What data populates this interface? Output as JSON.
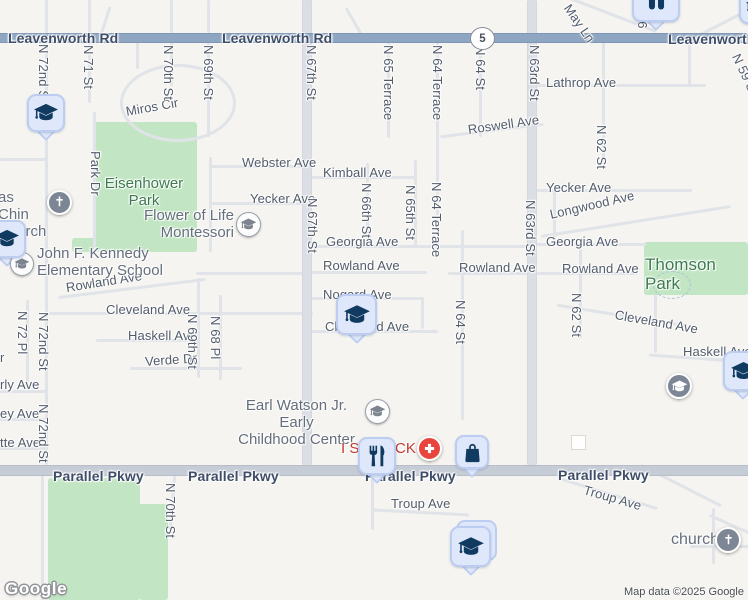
{
  "map": {
    "logo": "Google",
    "attribution": "Map data ©2025 Google",
    "route_shield": {
      "number": "5",
      "x": 470,
      "y": 27
    },
    "colors": {
      "background": "#f5f4f0",
      "highway_road": "#8ea6c2",
      "parkway_road": "#c6ccd5",
      "minor_road": "#e0e3e8",
      "park_green": "#c2e6c3",
      "park_label_green": "#3c7b50",
      "street_label": "#525c6b",
      "poi_label_gray": "#656e7c",
      "poi_label_red": "#c03a30",
      "marker_fill": "#dfe8fa",
      "marker_border": "#bccdf1",
      "marker_glyph": "#113a60",
      "poi_circle_gray": "#7d8694",
      "poi_circle_red": "#e8453c"
    },
    "parks": [
      {
        "x": 93,
        "y": 122,
        "w": 104,
        "h": 130
      },
      {
        "x": 72,
        "y": 238,
        "w": 125,
        "h": 14
      },
      {
        "x": 644,
        "y": 242,
        "w": 104,
        "h": 53
      },
      {
        "x": 48,
        "y": 478,
        "w": 92,
        "h": 122
      },
      {
        "x": 139,
        "y": 504,
        "w": 29,
        "h": 96
      }
    ],
    "park_trails": [
      {
        "x": 653,
        "y": 271,
        "w": 36,
        "h": 26
      }
    ],
    "buildings": [
      {
        "x": 571,
        "y": 435,
        "w": 13,
        "h": 13
      }
    ],
    "roads": [
      {
        "cls": "st",
        "x": 45,
        "y": 0,
        "w": 3,
        "h": 33
      },
      {
        "cls": "st",
        "x": 45,
        "y": 41,
        "w": 3,
        "h": 424
      },
      {
        "cls": "st",
        "x": 41,
        "y": 474,
        "w": 3,
        "h": 126
      },
      {
        "cls": "st",
        "x": 88,
        "y": 0,
        "w": 3,
        "h": 33
      },
      {
        "cls": "st",
        "x": 88,
        "y": 41,
        "w": 3,
        "h": 62
      },
      {
        "cls": "st",
        "x": 170,
        "y": 0,
        "w": 3,
        "h": 33
      },
      {
        "cls": "st",
        "x": 170,
        "y": 41,
        "w": 3,
        "h": 45
      },
      {
        "cls": "st",
        "x": 207,
        "y": 0,
        "w": 3,
        "h": 33
      },
      {
        "cls": "st",
        "x": 207,
        "y": 41,
        "w": 3,
        "h": 96
      },
      {
        "cls": "st",
        "x": 93,
        "y": 112,
        "w": 3,
        "h": 140
      },
      {
        "cls": "st",
        "x": 136,
        "y": 41,
        "w": 3,
        "h": 28
      },
      {
        "cls": "st",
        "x": 387,
        "y": 41,
        "w": 3,
        "h": 97
      },
      {
        "cls": "st",
        "x": 436,
        "y": 41,
        "w": 3,
        "h": 206
      },
      {
        "cls": "st",
        "x": 479,
        "y": 41,
        "w": 3,
        "h": 96
      },
      {
        "cls": "st",
        "x": 602,
        "y": 41,
        "w": 3,
        "h": 120
      },
      {
        "cls": "st",
        "x": 688,
        "y": 41,
        "w": 3,
        "h": 46
      },
      {
        "cls": "st",
        "x": 553,
        "y": 190,
        "w": 3,
        "h": 55
      },
      {
        "cls": "st",
        "x": 366,
        "y": 163,
        "w": 3,
        "h": 84
      },
      {
        "cls": "st",
        "x": 414,
        "y": 160,
        "w": 3,
        "h": 87
      },
      {
        "cls": "st",
        "x": 461,
        "y": 230,
        "w": 3,
        "h": 190
      },
      {
        "cls": "st",
        "x": 579,
        "y": 248,
        "w": 3,
        "h": 90
      },
      {
        "cls": "st",
        "x": 654,
        "y": 295,
        "w": 3,
        "h": 58
      },
      {
        "cls": "st",
        "x": 209,
        "y": 157,
        "w": 3,
        "h": 95
      },
      {
        "cls": "st",
        "x": 197,
        "y": 278,
        "w": 3,
        "h": 100
      },
      {
        "cls": "st",
        "x": 219,
        "y": 295,
        "w": 3,
        "h": 85
      },
      {
        "cls": "st",
        "x": 26,
        "y": 300,
        "w": 3,
        "h": 82
      },
      {
        "cls": "st",
        "x": 171,
        "y": 474,
        "w": 3,
        "h": 56,
        "rot": 5
      },
      {
        "cls": "st",
        "x": 371,
        "y": 474,
        "w": 3,
        "h": 56
      },
      {
        "cls": "st",
        "x": 421,
        "y": 297,
        "w": 3,
        "h": 32
      },
      {
        "cls": "st",
        "x": 712,
        "y": 508,
        "w": 3,
        "h": 56
      },
      {
        "cls": "st",
        "x": 104,
        "y": 6,
        "w": 3,
        "h": 30,
        "rot": 18
      },
      {
        "cls": "st",
        "x": 352,
        "y": 6,
        "w": 3,
        "h": 30,
        "rot": -30
      },
      {
        "cls": "st",
        "x": 536,
        "y": 84,
        "w": 170,
        "h": 3
      },
      {
        "cls": "st",
        "x": 440,
        "y": 129,
        "w": 104,
        "h": 3,
        "rot": -7
      },
      {
        "cls": "st",
        "x": 209,
        "y": 165,
        "w": 96,
        "h": 3
      },
      {
        "cls": "st",
        "x": 311,
        "y": 176,
        "w": 106,
        "h": 3
      },
      {
        "cls": "st",
        "x": 212,
        "y": 202,
        "w": 93,
        "h": 3
      },
      {
        "cls": "st",
        "x": 536,
        "y": 189,
        "w": 156,
        "h": 3
      },
      {
        "cls": "st",
        "x": 311,
        "y": 245,
        "w": 219,
        "h": 3
      },
      {
        "cls": "st",
        "x": 536,
        "y": 243,
        "w": 110,
        "h": 3
      },
      {
        "cls": "st",
        "x": 540,
        "y": 220,
        "w": 192,
        "h": 3,
        "rot": -9
      },
      {
        "cls": "st",
        "x": 58,
        "y": 287,
        "w": 148,
        "h": 3,
        "rot": -7
      },
      {
        "cls": "st",
        "x": 196,
        "y": 272,
        "w": 117,
        "h": 3
      },
      {
        "cls": "st",
        "x": 311,
        "y": 271,
        "w": 116,
        "h": 3
      },
      {
        "cls": "st",
        "x": 448,
        "y": 272,
        "w": 82,
        "h": 3
      },
      {
        "cls": "st",
        "x": 536,
        "y": 272,
        "w": 102,
        "h": 3
      },
      {
        "cls": "st",
        "x": 311,
        "y": 297,
        "w": 113,
        "h": 3
      },
      {
        "cls": "st",
        "x": 46,
        "y": 312,
        "w": 267,
        "h": 3
      },
      {
        "cls": "st",
        "x": 311,
        "y": 330,
        "w": 127,
        "h": 3
      },
      {
        "cls": "st",
        "x": 556,
        "y": 314,
        "w": 132,
        "h": 3,
        "rot": 9
      },
      {
        "cls": "st",
        "x": 96,
        "y": 339,
        "w": 104,
        "h": 3
      },
      {
        "cls": "st",
        "x": 649,
        "y": 357,
        "w": 100,
        "h": 3,
        "rot": 4
      },
      {
        "cls": "st",
        "x": 130,
        "y": 367,
        "w": 112,
        "h": 3
      },
      {
        "cls": "st",
        "x": 373,
        "y": 511,
        "w": 96,
        "h": 3,
        "rot": 3
      },
      {
        "cls": "st",
        "x": 556,
        "y": 492,
        "w": 104,
        "h": 3,
        "rot": 17
      },
      {
        "cls": "st",
        "x": 0,
        "y": 390,
        "w": 47,
        "h": 3
      },
      {
        "cls": "st",
        "x": 0,
        "y": 418,
        "w": 47,
        "h": 3
      },
      {
        "cls": "st",
        "x": 0,
        "y": 447,
        "w": 47,
        "h": 3
      },
      {
        "cls": "st",
        "x": 0,
        "y": 158,
        "w": 47,
        "h": 3
      },
      {
        "cls": "st",
        "x": 0,
        "y": 230,
        "w": 47,
        "h": 3
      },
      {
        "cls": "st",
        "x": 548,
        "y": 10,
        "w": 112,
        "h": 3,
        "rot": 21
      },
      {
        "cls": "st",
        "x": 690,
        "y": 18,
        "w": 80,
        "h": 3,
        "rot": -27
      },
      {
        "cls": "st",
        "x": 636,
        "y": 484,
        "w": 90,
        "h": 3,
        "rot": 27
      },
      {
        "cls": "st",
        "x": 706,
        "y": 530,
        "w": 80,
        "h": 3,
        "rot": 24
      },
      {
        "cls": "st",
        "x": 690,
        "y": 545,
        "w": 60,
        "h": 3
      },
      {
        "cls": "ellipse",
        "x": 120,
        "y": 64,
        "w": 110,
        "h": 72
      },
      {
        "cls": "col",
        "x": 303,
        "y": 0,
        "w": 8,
        "h": 465
      },
      {
        "cls": "col",
        "x": 528,
        "y": 0,
        "w": 8,
        "h": 465
      },
      {
        "cls": "hwy",
        "x": 0,
        "y": 33,
        "w": 748,
        "h": 8
      },
      {
        "cls": "pkwy",
        "x": 0,
        "y": 465,
        "w": 748,
        "h": 9
      }
    ],
    "street_labels": [
      {
        "t": "Leavenworth Rd",
        "x": 8,
        "y": 30,
        "major": true
      },
      {
        "t": "Leavenworth Rd",
        "x": 222,
        "y": 30,
        "major": true
      },
      {
        "t": "Leavenworth Rd",
        "x": 668,
        "y": 31,
        "major": true
      },
      {
        "t": "Parallel Pkwy",
        "x": 53,
        "y": 468,
        "major": true
      },
      {
        "t": "Parallel Pkwy",
        "x": 188,
        "y": 468,
        "major": true
      },
      {
        "t": "Parallel Pkwy",
        "x": 365,
        "y": 468,
        "major": true
      },
      {
        "t": "Parallel Pkwy",
        "x": 558,
        "y": 467,
        "major": true
      },
      {
        "t": "Lathrop Ave",
        "x": 546,
        "y": 75
      },
      {
        "t": "Roswell Ave",
        "x": 468,
        "y": 122,
        "rot": -8
      },
      {
        "t": "Webster Ave",
        "x": 242,
        "y": 155
      },
      {
        "t": "Kimball Ave",
        "x": 323,
        "y": 165
      },
      {
        "t": "Yecker Ave",
        "x": 250,
        "y": 191
      },
      {
        "t": "Yecker Ave",
        "x": 546,
        "y": 180
      },
      {
        "t": "Georgia Ave",
        "x": 326,
        "y": 234
      },
      {
        "t": "Georgia Ave",
        "x": 546,
        "y": 234
      },
      {
        "t": "Longwood Ave",
        "x": 550,
        "y": 207,
        "rot": -13
      },
      {
        "t": "Rowland Ave",
        "x": 66,
        "y": 280,
        "rot": -9
      },
      {
        "t": "Rowland Ave",
        "x": 323,
        "y": 258
      },
      {
        "t": "Rowland Ave",
        "x": 459,
        "y": 260
      },
      {
        "t": "Rowland Ave",
        "x": 562,
        "y": 261
      },
      {
        "t": "Nogard Ave",
        "x": 323,
        "y": 287
      },
      {
        "t": "Cleveland Ave",
        "x": 106,
        "y": 302
      },
      {
        "t": "Cleveland Ave",
        "x": 325,
        "y": 319
      },
      {
        "t": "Cleveland Ave",
        "x": 615,
        "y": 307,
        "rot": 10
      },
      {
        "t": "Haskell Ave",
        "x": 128,
        "y": 328
      },
      {
        "t": "Haskell Ave",
        "x": 683,
        "y": 344
      },
      {
        "t": "Verde Dr",
        "x": 145,
        "y": 354,
        "rot": -4
      },
      {
        "t": "Troup Ave",
        "x": 391,
        "y": 496
      },
      {
        "t": "Troup Ave",
        "x": 584,
        "y": 482,
        "rot": 16
      },
      {
        "t": "Miros Cir",
        "x": 126,
        "y": 104,
        "rot": -10
      },
      {
        "t": "May Ln",
        "x": 567,
        "y": -2,
        "rot": 55
      },
      {
        "t": "N 59 St",
        "x": 736,
        "y": 47,
        "rot": 65
      },
      {
        "t": "rly Ave",
        "x": 0,
        "y": 377
      },
      {
        "t": "r",
        "x": 0,
        "y": 350
      },
      {
        "t": "ey Ave",
        "x": 0,
        "y": 406
      },
      {
        "t": "tte Ave",
        "x": 0,
        "y": 435
      },
      {
        "t": "N 72nd St",
        "x": 36,
        "y": 44,
        "v": true
      },
      {
        "t": "N 71 St",
        "x": 81,
        "y": 45,
        "v": true
      },
      {
        "t": "N 70th St",
        "x": 161,
        "y": 45,
        "v": true
      },
      {
        "t": "N 69th St",
        "x": 201,
        "y": 45,
        "v": true
      },
      {
        "t": "N 67th St",
        "x": 304,
        "y": 45,
        "v": true
      },
      {
        "t": "N 65 Terrace",
        "x": 381,
        "y": 45,
        "v": true
      },
      {
        "t": "N 64 Terrace",
        "x": 430,
        "y": 45,
        "v": true
      },
      {
        "t": "N 64 St",
        "x": 473,
        "y": 46,
        "v": true
      },
      {
        "t": "N 63rd St",
        "x": 527,
        "y": 45,
        "v": true
      },
      {
        "t": "N 6",
        "x": 635,
        "y": 8,
        "v": true
      },
      {
        "t": "N 62 St",
        "x": 594,
        "y": 125,
        "v": true
      },
      {
        "t": "Park Dr",
        "x": 88,
        "y": 151,
        "v": true
      },
      {
        "t": "N 67th St",
        "x": 305,
        "y": 198,
        "v": true
      },
      {
        "t": "N 66th St",
        "x": 359,
        "y": 183,
        "v": true
      },
      {
        "t": "N 65th St",
        "x": 403,
        "y": 185,
        "v": true
      },
      {
        "t": "N 64 Terrace",
        "x": 429,
        "y": 182,
        "v": true
      },
      {
        "t": "N 63rd St",
        "x": 523,
        "y": 200,
        "v": true
      },
      {
        "t": "N 62 St",
        "x": 569,
        "y": 293,
        "v": true
      },
      {
        "t": "N 64 St",
        "x": 453,
        "y": 300,
        "v": true
      },
      {
        "t": "N 69th St",
        "x": 185,
        "y": 314,
        "v": true
      },
      {
        "t": "N 68 Pl",
        "x": 208,
        "y": 316,
        "v": true
      },
      {
        "t": "N 72 Pl",
        "x": 15,
        "y": 311,
        "v": true
      },
      {
        "t": "N 72nd St",
        "x": 36,
        "y": 312,
        "v": true
      },
      {
        "t": "N 72nd St",
        "x": 36,
        "y": 404,
        "v": true
      },
      {
        "t": "N 70th St",
        "x": 163,
        "y": 483,
        "v": true
      }
    ],
    "poi_labels": [
      {
        "lines": [
          "Eisenhower",
          "Park"
        ],
        "x": 98,
        "y": 176,
        "w": 92,
        "align": "center",
        "cls": "park-label",
        "size": 15
      },
      {
        "lines": [
          "Thomson Park"
        ],
        "x": 645,
        "y": 255,
        "w": 110,
        "align": "left",
        "cls": "park-label",
        "size": 17
      },
      {
        "lines": [
          "Flower of Life",
          "Montessori"
        ],
        "x": 138,
        "y": 208,
        "w": 96,
        "align": "right",
        "cls": "poi-gray",
        "size": 15
      },
      {
        "lines": [
          "John F. Kennedy",
          "Elementary School"
        ],
        "x": 37,
        "y": 246,
        "w": 130,
        "align": "left",
        "cls": "poi-gray",
        "size": 15
      },
      {
        "lines": [
          "Earl Watson Jr. Early",
          "Childhood Center"
        ],
        "x": 228,
        "y": 398,
        "w": 137,
        "align": "center",
        "cls": "poi-gray",
        "size": 15
      },
      {
        "lines": [
          "as Chin",
          "Church"
        ],
        "x": -2,
        "y": 190,
        "w": 48,
        "align": "left",
        "cls": "poi-gray",
        "size": 15
      },
      {
        "lines": [
          "church"
        ],
        "x": 671,
        "y": 531,
        "w": 48,
        "align": "left",
        "cls": "poi-gray",
        "size": 16
      },
      {
        "lines": [
          "I S"
        ],
        "x": 341,
        "y": 441,
        "w": 24,
        "align": "left",
        "cls": "poi-red",
        "size": 15
      },
      {
        "lines": [
          "CK"
        ],
        "x": 395,
        "y": 441,
        "w": 24,
        "align": "left",
        "cls": "poi-red",
        "size": 15
      }
    ],
    "markers": [
      {
        "id": "school-pin-1",
        "type": "square",
        "icon": "graduation-cap",
        "x": 27,
        "y": 94,
        "size": 38
      },
      {
        "id": "school-circle-1",
        "type": "circle",
        "variant": "white",
        "icon": "graduation-cap",
        "x": 10,
        "y": 252,
        "size": 24
      },
      {
        "id": "school-pin-2",
        "type": "square",
        "icon": "graduation-cap",
        "x": -12,
        "y": 220,
        "size": 38
      },
      {
        "id": "church-circle-1",
        "type": "circle",
        "variant": "gray",
        "icon": "church-cross",
        "x": 47,
        "y": 190,
        "size": 25
      },
      {
        "id": "school-circle-2",
        "type": "circle",
        "variant": "white",
        "icon": "graduation-cap",
        "x": 236,
        "y": 212,
        "size": 25
      },
      {
        "id": "school-pin-3",
        "type": "square",
        "icon": "graduation-cap",
        "x": 336,
        "y": 294,
        "size": 41
      },
      {
        "id": "school-circle-3",
        "type": "circle",
        "variant": "white",
        "icon": "graduation-cap",
        "x": 365,
        "y": 399,
        "size": 25
      },
      {
        "id": "medical-circle",
        "type": "circle",
        "variant": "red",
        "icon": "medical-cross",
        "x": 417,
        "y": 436,
        "size": 25
      },
      {
        "id": "restaurant-pin",
        "type": "square",
        "icon": "fork-knife",
        "x": 358,
        "y": 437,
        "size": 38
      },
      {
        "id": "shopping-pin",
        "type": "square",
        "icon": "shopping-bag",
        "x": 455,
        "y": 435,
        "size": 34
      },
      {
        "id": "school-pin-stack",
        "type": "square",
        "icon": "graduation-cap",
        "x": 450,
        "y": 526,
        "size": 41,
        "stacked": true
      },
      {
        "id": "school-circle-4",
        "type": "circle",
        "variant": "gray",
        "icon": "graduation-cap",
        "x": 666,
        "y": 373,
        "size": 26
      },
      {
        "id": "school-pin-4",
        "type": "square",
        "icon": "graduation-cap",
        "x": 723,
        "y": 351,
        "size": 40
      },
      {
        "id": "columns-pin",
        "type": "square",
        "icon": "columns",
        "x": 632,
        "y": -26,
        "size": 48
      },
      {
        "id": "corner-pin",
        "type": "square",
        "icon": "graduation-cap",
        "x": 739,
        "y": -12,
        "size": 36
      },
      {
        "id": "church-circle-2",
        "type": "circle",
        "variant": "gray",
        "icon": "church-cross",
        "x": 715,
        "y": 527,
        "size": 26
      }
    ]
  }
}
